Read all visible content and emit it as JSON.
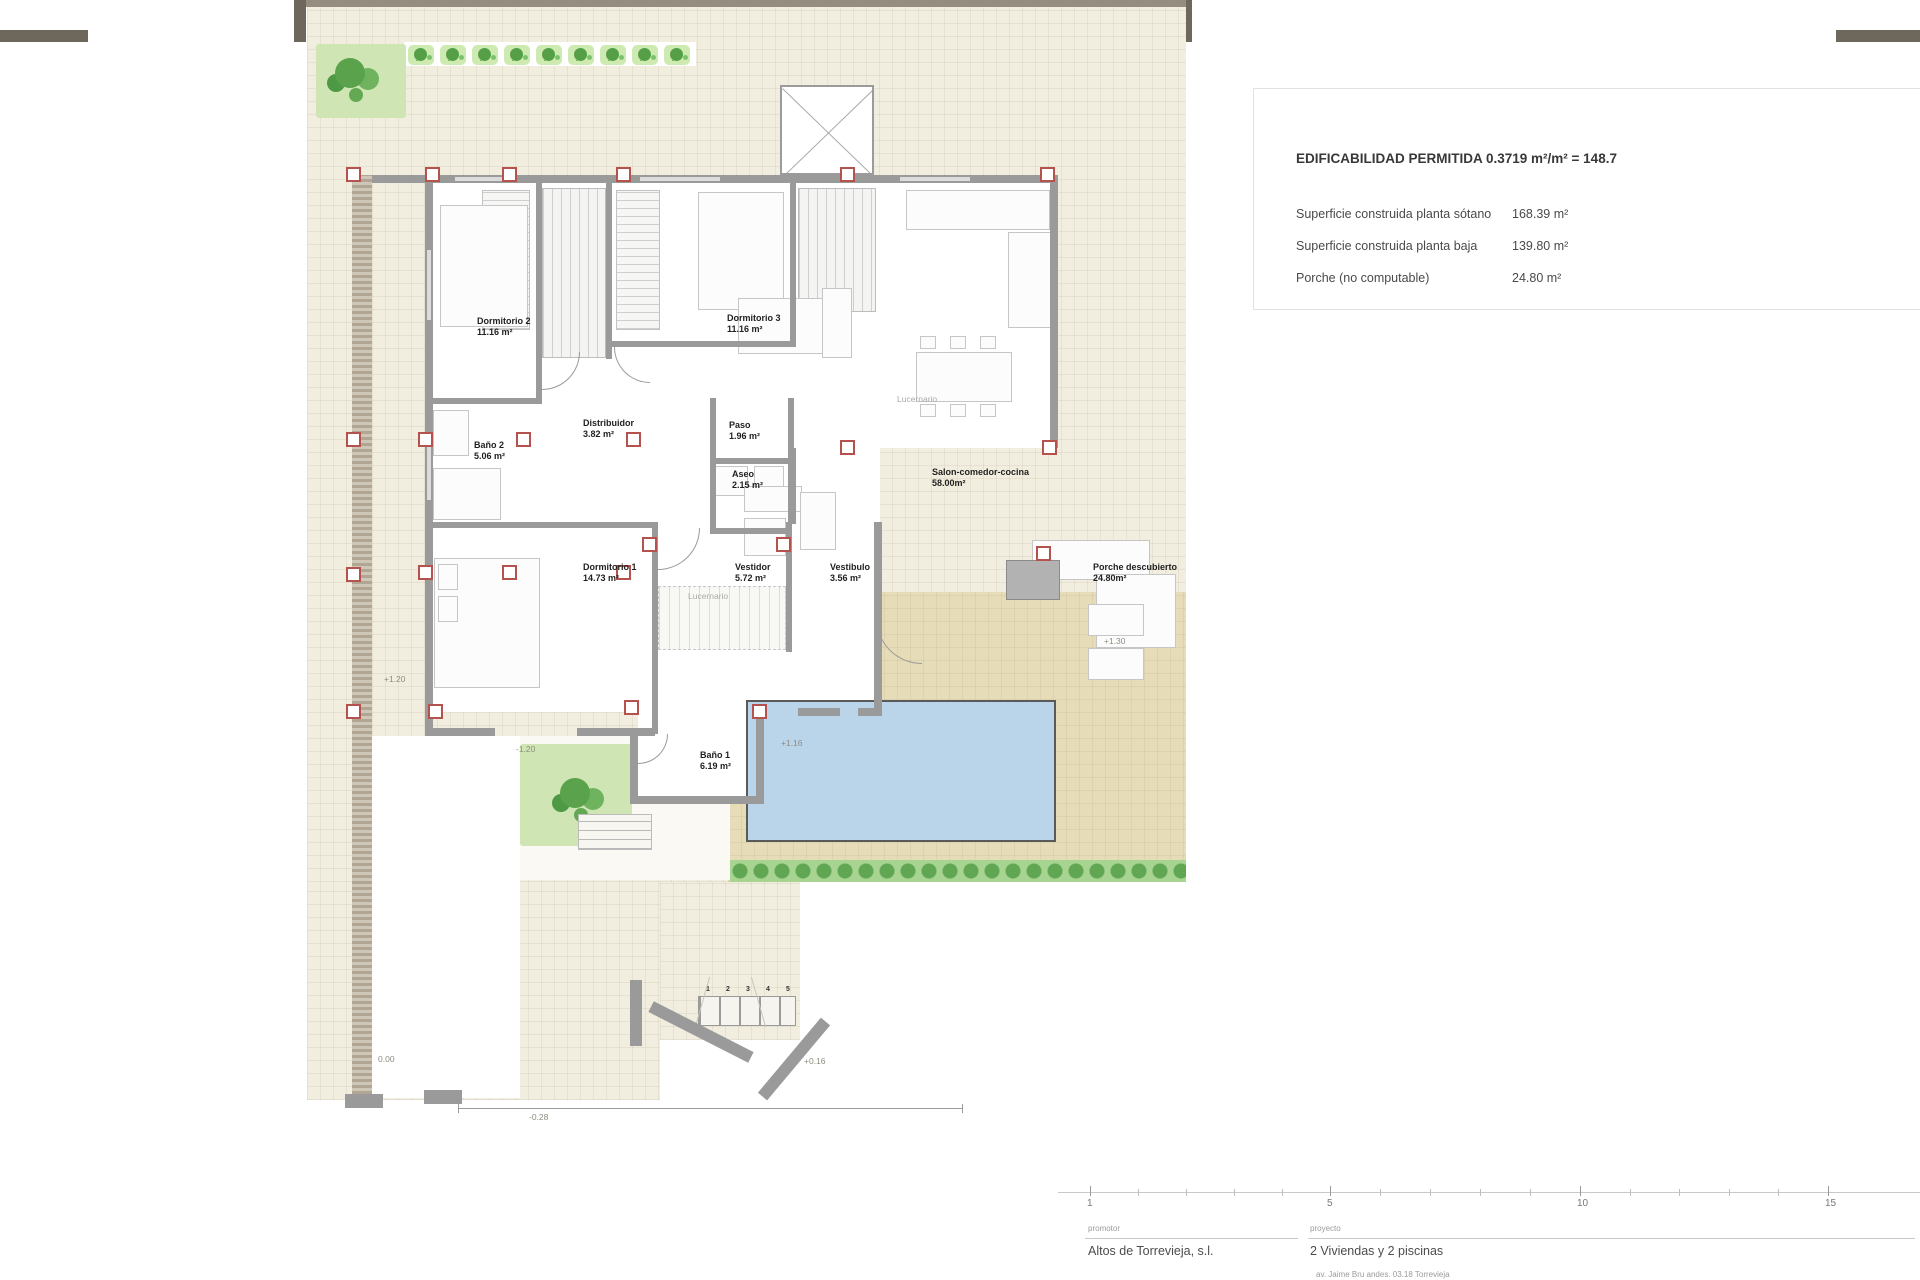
{
  "panel": {
    "title": "EDIFICABILIDAD PERMITIDA 0.3719 m²/m² = 148.7",
    "rows": [
      {
        "label": "Superficie construida planta sótano",
        "value": "168.39 m²"
      },
      {
        "label": "Superficie construida planta baja",
        "value": "139.80 m²"
      },
      {
        "label": "Porche (no computable)",
        "value": "24.80 m²"
      }
    ]
  },
  "plan": {
    "rooms": [
      {
        "name": "Dormitorio 2",
        "area": "11.16 m²",
        "x": 477,
        "y": 316
      },
      {
        "name": "Dormitorio 3",
        "area": "11.16 m²",
        "x": 727,
        "y": 313
      },
      {
        "name": "Baño 2",
        "area": "5.06 m²",
        "x": 474,
        "y": 440
      },
      {
        "name": "Distribuidor",
        "area": "3.82 m²",
        "x": 583,
        "y": 418
      },
      {
        "name": "Paso",
        "area": "1.96 m²",
        "x": 729,
        "y": 420
      },
      {
        "name": "Aseo",
        "area": "2.15 m²",
        "x": 732,
        "y": 469
      },
      {
        "name": "Salon-comedor-cocina",
        "area": "58.00m²",
        "x": 932,
        "y": 467
      },
      {
        "name": "Dormitorio 1",
        "area": "14.73 m²",
        "x": 583,
        "y": 562
      },
      {
        "name": "Vestidor",
        "area": "5.72 m²",
        "x": 735,
        "y": 562
      },
      {
        "name": "Vestibulo",
        "area": "3.56 m²",
        "x": 830,
        "y": 562
      },
      {
        "name": "Porche descubierto",
        "area": "24.80m²",
        "x": 1093,
        "y": 562
      },
      {
        "name": "Baño 1",
        "area": "6.19 m²",
        "x": 700,
        "y": 750
      }
    ],
    "gray_labels": [
      {
        "text": "Lucernario",
        "x": 897,
        "y": 394
      },
      {
        "text": "Lucernario",
        "x": 688,
        "y": 591
      }
    ],
    "levels": [
      {
        "text": "+1.20",
        "x": 384,
        "y": 674
      },
      {
        "text": "-1.20",
        "x": 516,
        "y": 744
      },
      {
        "text": "+1.30",
        "x": 1104,
        "y": 636
      },
      {
        "text": "+1.16",
        "x": 781,
        "y": 738
      },
      {
        "text": "+0.16",
        "x": 804,
        "y": 1056
      },
      {
        "text": "0.00",
        "x": 378,
        "y": 1054
      },
      {
        "text": "-0.28",
        "x": 529,
        "y": 1112
      }
    ],
    "pillars": [
      [
        346,
        167
      ],
      [
        425,
        167
      ],
      [
        502,
        167
      ],
      [
        616,
        167
      ],
      [
        840,
        167
      ],
      [
        1040,
        167
      ],
      [
        346,
        432
      ],
      [
        418,
        432
      ],
      [
        516,
        432
      ],
      [
        626,
        432
      ],
      [
        840,
        440
      ],
      [
        1042,
        440
      ],
      [
        346,
        567
      ],
      [
        418,
        565
      ],
      [
        502,
        565
      ],
      [
        616,
        565
      ],
      [
        642,
        537
      ],
      [
        776,
        537
      ],
      [
        346,
        704
      ],
      [
        428,
        704
      ],
      [
        624,
        700
      ],
      [
        752,
        704
      ],
      [
        1036,
        546
      ]
    ],
    "hedge_row": {
      "x": 408,
      "y": 45,
      "count": 9,
      "step": 32
    },
    "stair_steps": [
      "1",
      "2",
      "3",
      "4",
      "5"
    ]
  },
  "title_block": {
    "scale_ticks": [
      {
        "label": "1",
        "x": 1090
      },
      {
        "label": "5",
        "x": 1330
      },
      {
        "label": "10",
        "x": 1580
      },
      {
        "label": "15",
        "x": 1828
      }
    ],
    "promoter_label": "promotor",
    "promoter": "Altos de Torrevieja, s.l.",
    "project_label": "proyecto",
    "project": "2 Viviendas y 2 piscinas",
    "address": "av. Jaime Bru andes. 03.18 Torrevieja"
  },
  "colors": {
    "pillar": "#b5524e",
    "pool": "#bad4e9",
    "wall": "#9a9a9a",
    "hedge_green": "#61a653"
  }
}
